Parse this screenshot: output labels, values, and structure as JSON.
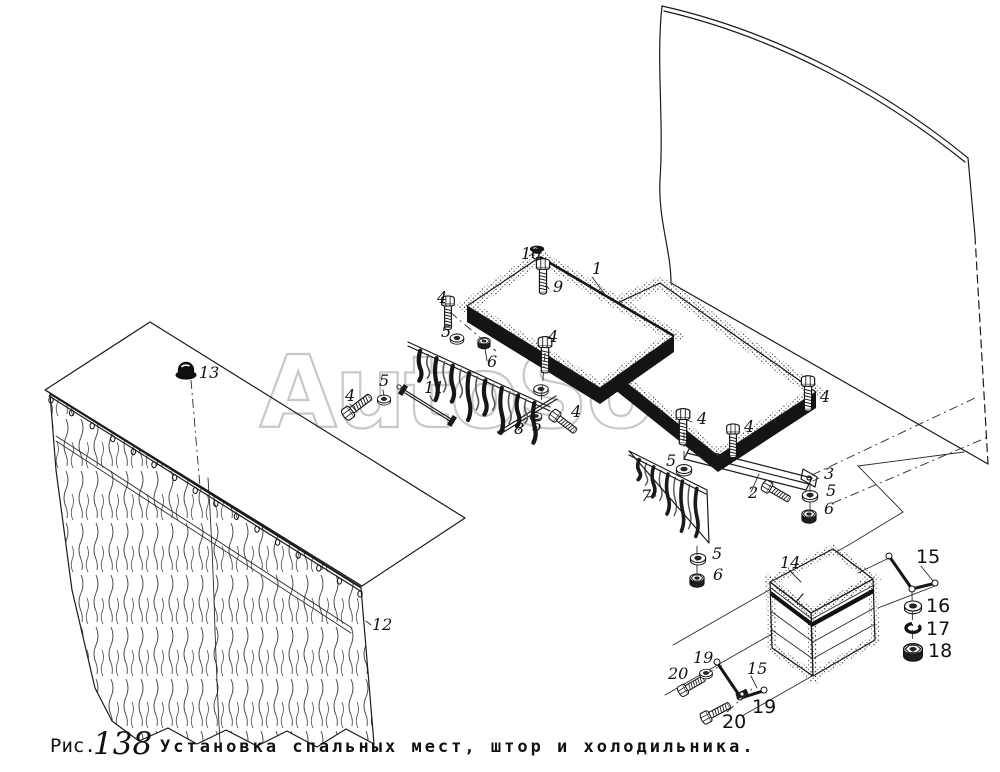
{
  "figure": {
    "label_prefix": "Рис.",
    "number": "138",
    "title": "Установка спальных мест, штор и холодильника."
  },
  "watermark_text": "AutoSoft",
  "colors": {
    "background": "#ffffff",
    "ink": "#1a1a1a",
    "watermark_gray": "#c8c8c8"
  },
  "part_labels": [
    {
      "text": "10",
      "x": 521,
      "y": 259,
      "style": "hand"
    },
    {
      "text": "9",
      "x": 553,
      "y": 292,
      "style": "hand"
    },
    {
      "text": "1",
      "x": 592,
      "y": 274,
      "style": "hand"
    },
    {
      "text": "4",
      "x": 437,
      "y": 303,
      "style": "hand"
    },
    {
      "text": "5",
      "x": 441,
      "y": 337,
      "style": "hand"
    },
    {
      "text": "6",
      "x": 487,
      "y": 367,
      "style": "hand"
    },
    {
      "text": "4",
      "x": 548,
      "y": 342,
      "style": "hand"
    },
    {
      "text": "4",
      "x": 345,
      "y": 401,
      "style": "hand"
    },
    {
      "text": "5",
      "x": 379,
      "y": 386,
      "style": "hand"
    },
    {
      "text": "11",
      "x": 424,
      "y": 393,
      "style": "hand"
    },
    {
      "text": "8",
      "x": 514,
      "y": 434,
      "style": "hand"
    },
    {
      "text": "5",
      "x": 532,
      "y": 431,
      "style": "hand"
    },
    {
      "text": "4",
      "x": 571,
      "y": 417,
      "style": "hand"
    },
    {
      "text": "4",
      "x": 697,
      "y": 424,
      "style": "hand"
    },
    {
      "text": "5",
      "x": 666,
      "y": 466,
      "style": "hand"
    },
    {
      "text": "7",
      "x": 641,
      "y": 501,
      "style": "hand"
    },
    {
      "text": "5",
      "x": 712,
      "y": 559,
      "style": "hand"
    },
    {
      "text": "6",
      "x": 713,
      "y": 580,
      "style": "hand"
    },
    {
      "text": "4",
      "x": 744,
      "y": 432,
      "style": "hand"
    },
    {
      "text": "4",
      "x": 820,
      "y": 402,
      "style": "hand"
    },
    {
      "text": "2",
      "x": 748,
      "y": 498,
      "style": "hand"
    },
    {
      "text": "3",
      "x": 824,
      "y": 479,
      "style": "hand"
    },
    {
      "text": "5",
      "x": 826,
      "y": 496,
      "style": "hand"
    },
    {
      "text": "6",
      "x": 824,
      "y": 514,
      "style": "hand"
    },
    {
      "text": "13",
      "x": 199,
      "y": 378,
      "style": "hand"
    },
    {
      "text": "12",
      "x": 372,
      "y": 630,
      "style": "hand"
    },
    {
      "text": "14",
      "x": 780,
      "y": 568,
      "style": "hand"
    },
    {
      "text": "15",
      "x": 916,
      "y": 563,
      "style": "print"
    },
    {
      "text": "16",
      "x": 926,
      "y": 612,
      "style": "print"
    },
    {
      "text": "17",
      "x": 926,
      "y": 635,
      "style": "print"
    },
    {
      "text": "18",
      "x": 928,
      "y": 657,
      "style": "print"
    },
    {
      "text": "19",
      "x": 693,
      "y": 663,
      "style": "hand"
    },
    {
      "text": "20",
      "x": 668,
      "y": 679,
      "style": "hand"
    },
    {
      "text": "15",
      "x": 747,
      "y": 674,
      "style": "hand"
    },
    {
      "text": "19",
      "x": 752,
      "y": 713,
      "style": "print"
    },
    {
      "text": "20",
      "x": 722,
      "y": 728,
      "style": "print"
    }
  ]
}
